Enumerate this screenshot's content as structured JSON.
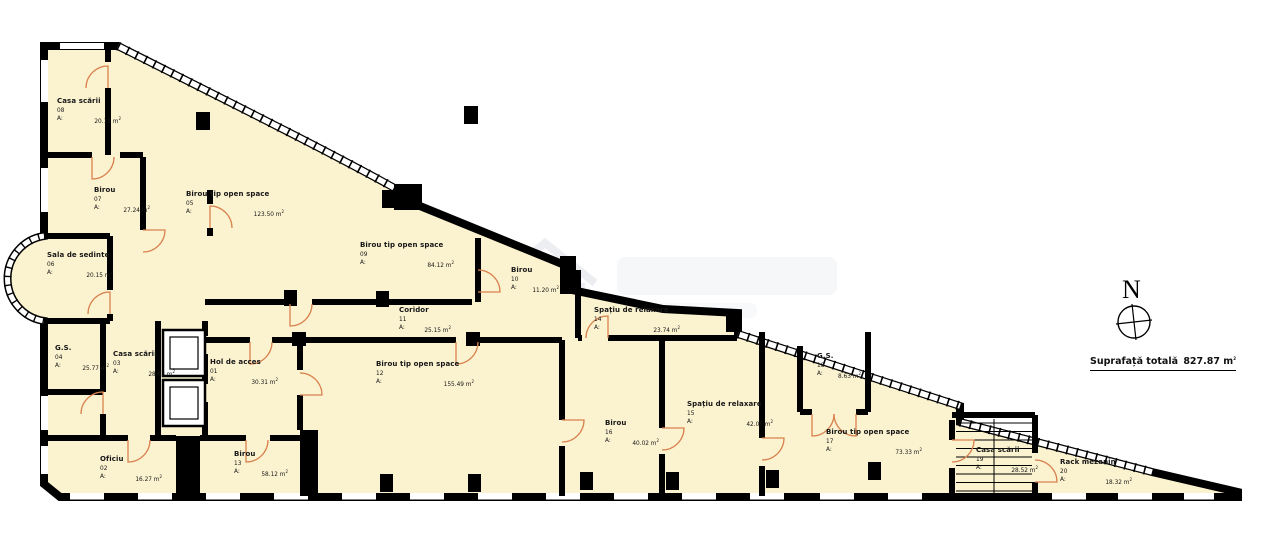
{
  "legend": {
    "total_label": "Suprafață totală",
    "total_value": "827.87",
    "area_prefix": "A:",
    "unit_base": "m",
    "unit_sup": "2"
  },
  "north": {
    "label": "N"
  },
  "colors": {
    "floor": "#fbf2d0",
    "wall": "#000000",
    "door": "#d9824f",
    "background": "#ffffff"
  },
  "rooms": [
    {
      "name": "Hol de acces",
      "number": "01",
      "area": "30.31",
      "pos": {
        "x": 210,
        "y": 358
      },
      "w": 68
    },
    {
      "name": "Oficiu",
      "number": "02",
      "area": "16.27",
      "pos": {
        "x": 100,
        "y": 455
      },
      "w": 62
    },
    {
      "name": "Casa scării",
      "number": "03",
      "area": "28.63",
      "pos": {
        "x": 113,
        "y": 350
      },
      "w": 62
    },
    {
      "name": "G.S.",
      "number": "04",
      "area": "25.77",
      "pos": {
        "x": 55,
        "y": 344
      },
      "w": 54
    },
    {
      "name": "Birou tip open space",
      "number": "05",
      "area": "123.50",
      "pos": {
        "x": 186,
        "y": 190
      },
      "w": 98
    },
    {
      "name": "Sala de sedinte",
      "number": "06",
      "area": "20.15",
      "pos": {
        "x": 47,
        "y": 251
      },
      "w": 66
    },
    {
      "name": "Birou",
      "number": "07",
      "area": "27.24",
      "pos": {
        "x": 94,
        "y": 186
      },
      "w": 56
    },
    {
      "name": "Casa scării",
      "number": "08",
      "area": "20.19",
      "pos": {
        "x": 57,
        "y": 97
      },
      "w": 64
    },
    {
      "name": "Birou tip open space",
      "number": "09",
      "area": "84.12",
      "pos": {
        "x": 360,
        "y": 241
      },
      "w": 94
    },
    {
      "name": "Birou",
      "number": "10",
      "area": "11.20",
      "pos": {
        "x": 511,
        "y": 266
      },
      "w": 48
    },
    {
      "name": "Coridor",
      "number": "11",
      "area": "25.15",
      "pos": {
        "x": 399,
        "y": 306
      },
      "w": 52
    },
    {
      "name": "Birou tip open space",
      "number": "12",
      "area": "155.49",
      "pos": {
        "x": 376,
        "y": 360
      },
      "w": 98
    },
    {
      "name": "Birou",
      "number": "13",
      "area": "58.12",
      "pos": {
        "x": 234,
        "y": 450
      },
      "w": 54
    },
    {
      "name": "Spațiu de relaxare",
      "number": "14",
      "area": "23.74",
      "pos": {
        "x": 594,
        "y": 306
      },
      "w": 86
    },
    {
      "name": "Spațiu de relaxare",
      "number": "15",
      "area": "42.06",
      "pos": {
        "x": 687,
        "y": 400
      },
      "w": 86
    },
    {
      "name": "Birou",
      "number": "16",
      "area": "40.02",
      "pos": {
        "x": 605,
        "y": 419
      },
      "w": 54
    },
    {
      "name": "Birou tip open space",
      "number": "17",
      "area": "73.33",
      "pos": {
        "x": 826,
        "y": 428
      },
      "w": 96
    },
    {
      "name": "G.S.",
      "number": "18",
      "area": "8.63",
      "pos": {
        "x": 817,
        "y": 352
      },
      "w": 44
    },
    {
      "name": "Casa scării",
      "number": "19",
      "area": "28.52",
      "pos": {
        "x": 976,
        "y": 446
      },
      "w": 62
    },
    {
      "name": "Rack mezanin",
      "number": "20",
      "area": "18.32",
      "pos": {
        "x": 1060,
        "y": 458
      },
      "w": 72
    }
  ]
}
